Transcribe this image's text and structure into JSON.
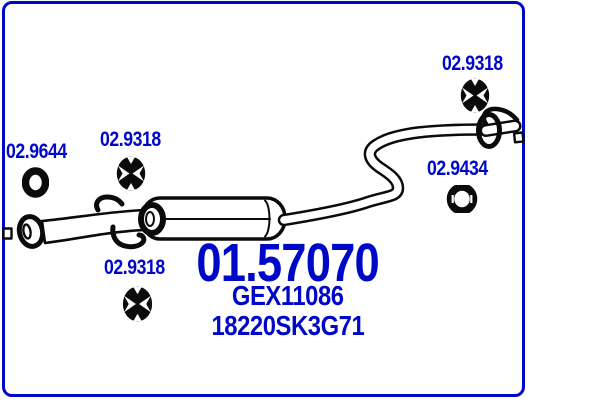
{
  "window": {
    "width": 600,
    "height": 400
  },
  "diagram": {
    "kind": "exhaust-middle-silencer-drawing",
    "main_part_number": "01.57070",
    "reference_1": "GEX11086",
    "reference_2": "18220SK3G71",
    "callouts": [
      {
        "part_number": "02.9644",
        "icon": "gasket-ring-icon"
      },
      {
        "part_number": "02.9318",
        "icon": "rubber-hanger-icon"
      },
      {
        "part_number": "02.9318",
        "icon": "rubber-hanger-icon"
      },
      {
        "part_number": "02.9434",
        "icon": "pipe-clamp-icon"
      },
      {
        "part_number": "02.9318",
        "icon": "rubber-hanger-icon"
      }
    ],
    "colors": {
      "accent": "#0008C8",
      "line": "#0B0B0B",
      "background": "#FFFFFF"
    }
  }
}
